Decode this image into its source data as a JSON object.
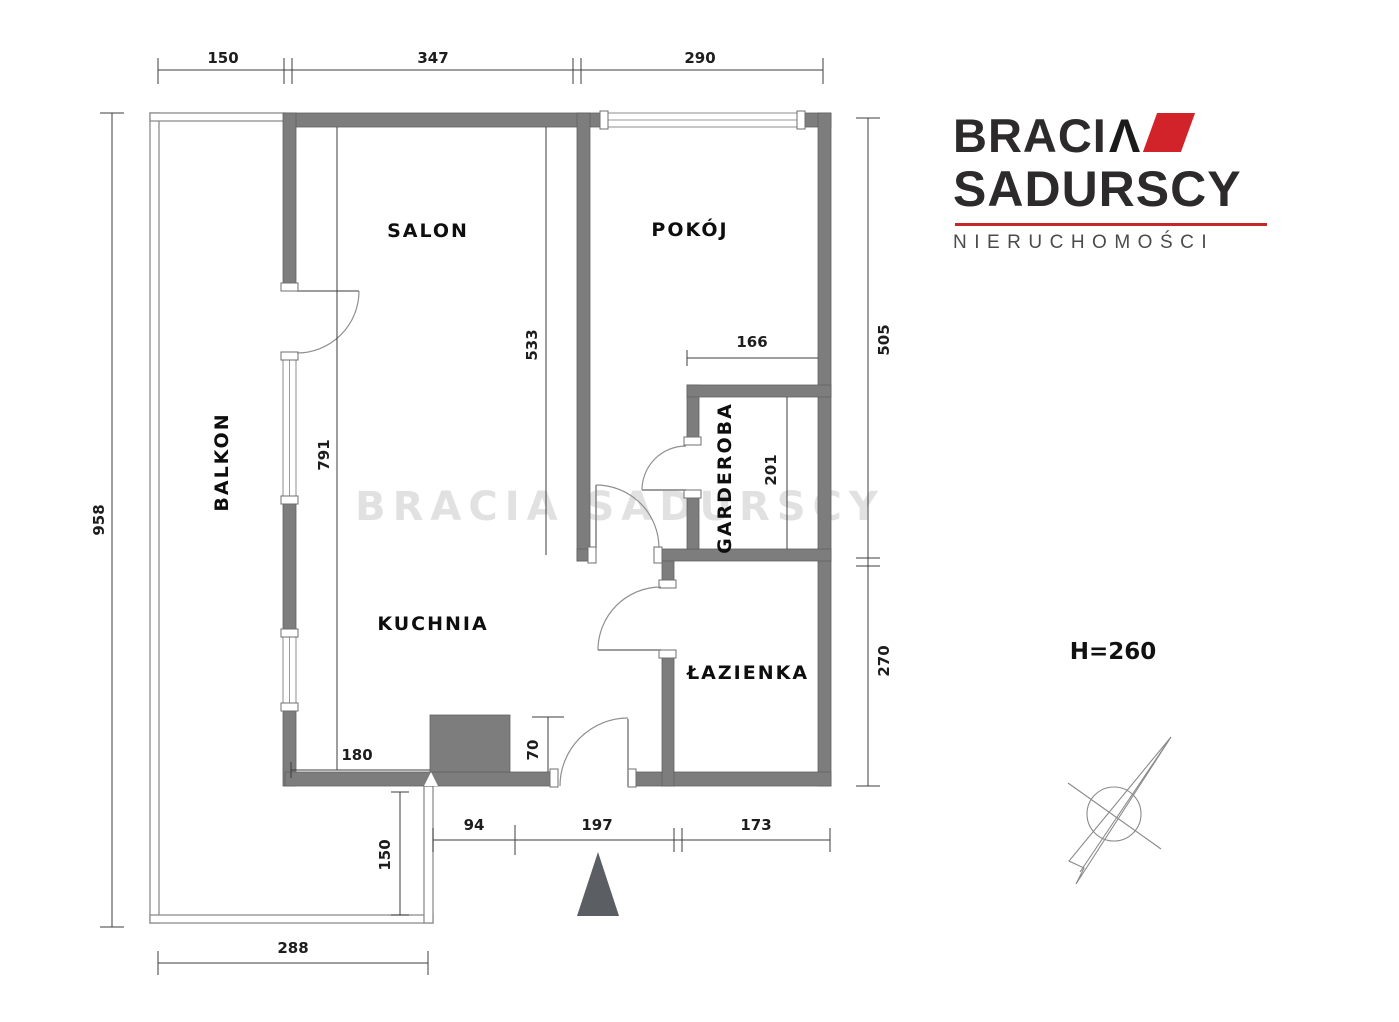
{
  "watermark": "BRACIA SADURSCY",
  "logo": {
    "brand_top": "BRACI",
    "brand_accent": "Λ",
    "brand_bottom": "SADURSCY",
    "tagline": "NIERUCHOMOŚCI"
  },
  "rooms": {
    "salon": "SALON",
    "pokoj": "POKÓJ",
    "balkon": "BALKON",
    "kuchnia": "KUCHNIA",
    "garderoba": "GARDEROBA",
    "lazienka": "ŁAZIENKA"
  },
  "annotations": {
    "ceiling_height": "H=260"
  },
  "dims": {
    "top_balcony": "150",
    "top_salon": "347",
    "top_pokoj": "290",
    "left_total": "958",
    "right_upper": "505",
    "right_lower": "270",
    "bottom_hall": "94",
    "bottom_entry": "197",
    "bottom_bath": "173",
    "balcony_width": "288",
    "balcony_depth": "150",
    "salon_depth": "533",
    "interior_height": "791",
    "kitchen_width": "180",
    "shaft_width": "70",
    "garderoba_width": "166",
    "garderoba_depth": "201"
  },
  "colors": {
    "wall_gray": "#7d7d7d",
    "accent_red": "#d2232a",
    "logo_dark": "#2c2a2b",
    "dim_text": "#1d1d1d"
  }
}
